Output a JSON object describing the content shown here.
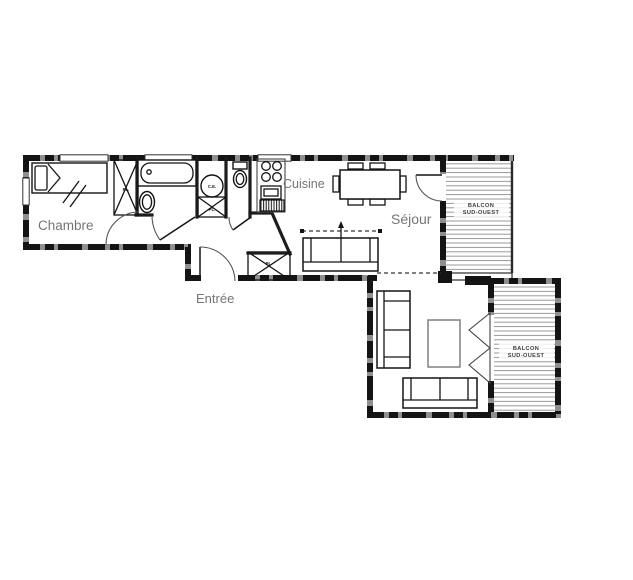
{
  "floor_plan": {
    "rooms": {
      "chambre": {
        "label": "Chambre"
      },
      "cuisine": {
        "label": "Cuisine"
      },
      "sejour": {
        "label": "Séjour"
      },
      "entree": {
        "label": "Entrée"
      }
    },
    "balconies": {
      "balcony_top": {
        "line1": "BALCON",
        "line2": "SUD-OUEST"
      },
      "balcony_bottom": {
        "line1": "BALCON",
        "line2": "SUD-OUEST"
      }
    },
    "fixtures": {
      "water_heater_label": "C.E.",
      "closet_label": "PL."
    },
    "colors": {
      "wall": "#141414",
      "wall_base": "#8f8f8f",
      "room_label_text": "#757575",
      "balcony_hatch": "#9a9a9a",
      "balcony_label_text": "#3f3f3f",
      "background": "#ffffff"
    }
  }
}
